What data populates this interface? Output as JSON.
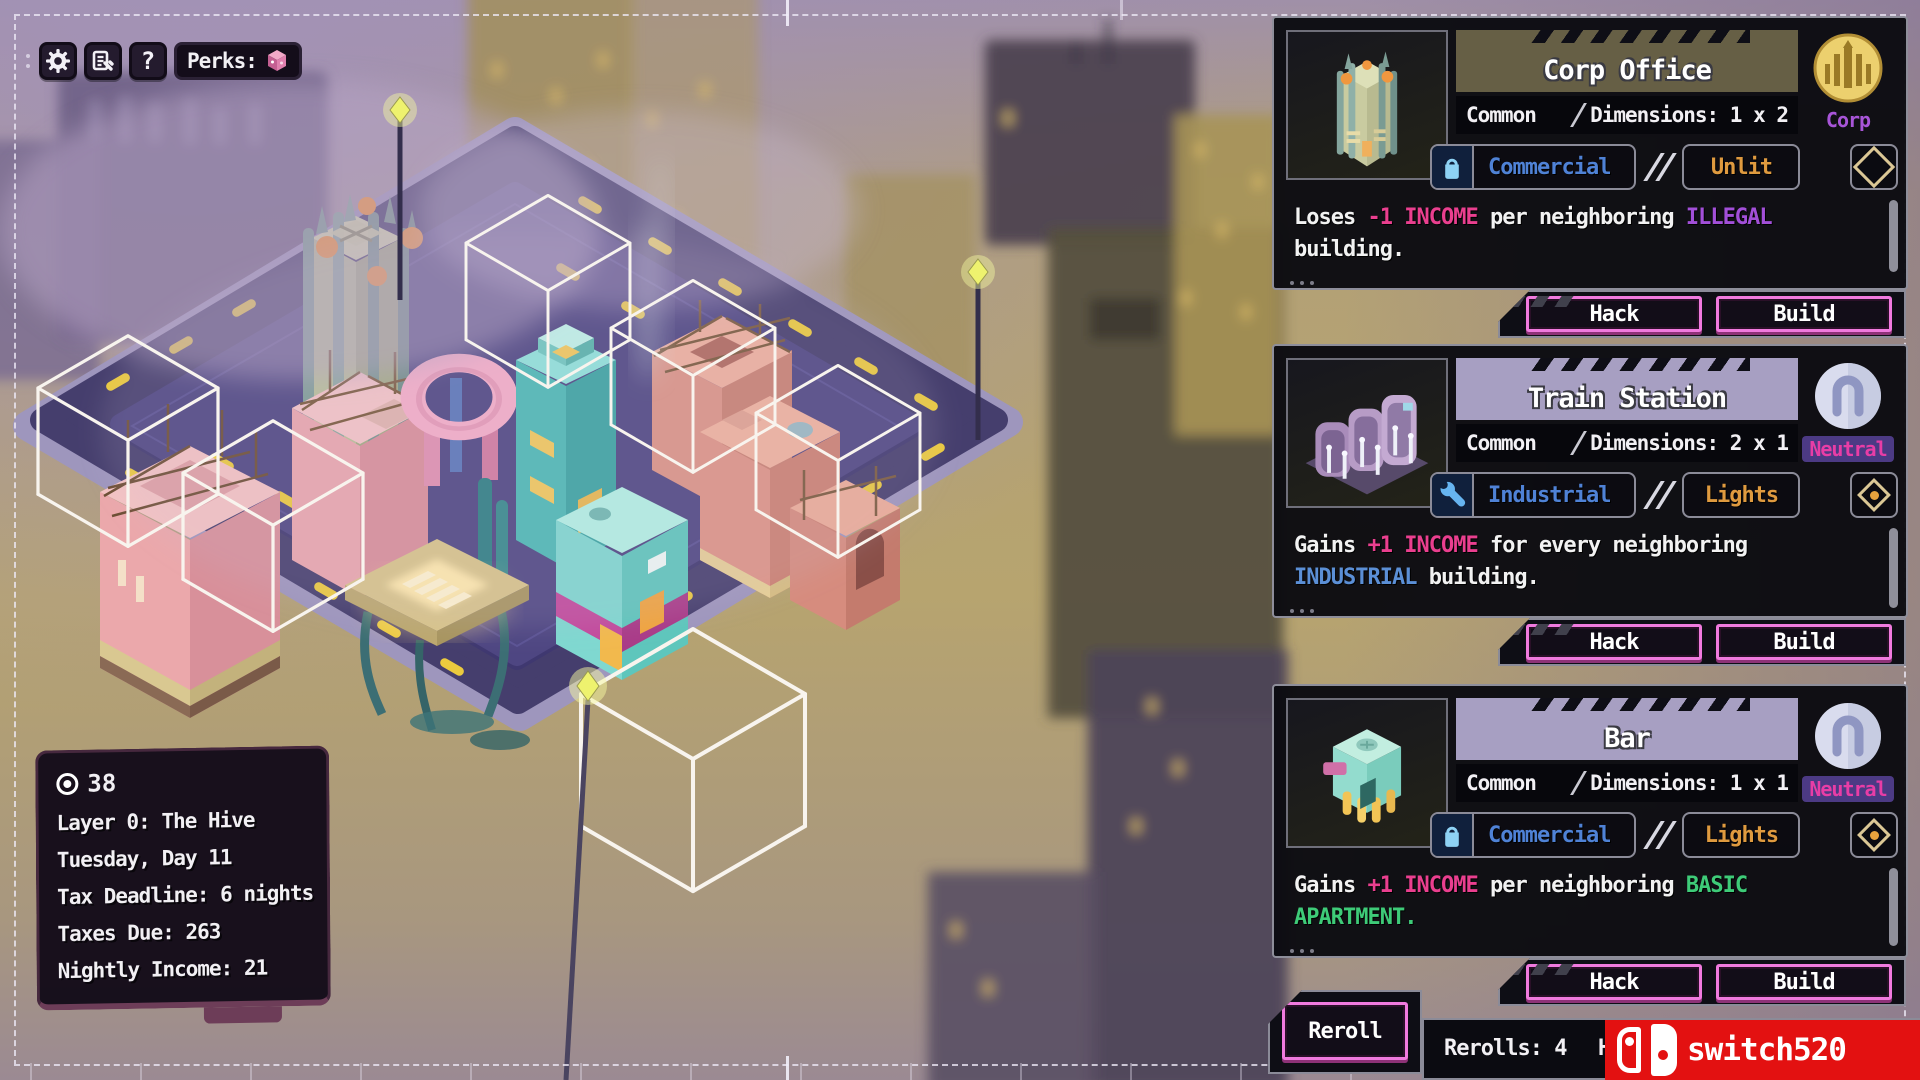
{
  "topbar": {
    "perks_label": "Perks:",
    "help_glyph": "?"
  },
  "stats": {
    "money": "38",
    "lines": [
      "Layer 0: The Hive",
      "Tuesday, Day 11",
      "Tax Deadline: 6 nights",
      "Taxes Due: 263",
      "Nightly Income: 21"
    ]
  },
  "cards": [
    {
      "title": "Corp Office",
      "rarity": "Common",
      "dimensions": "Dimensions: 1 x 2",
      "faction": "Corp",
      "category": "Commercial",
      "lighting": "Unlit",
      "description": [
        {
          "t": "Loses ",
          "c": "w"
        },
        {
          "t": "-1 INCOME",
          "c": "pk"
        },
        {
          "t": " per neighboring ",
          "c": "w"
        },
        {
          "t": "ILLEGAL",
          "c": "pu"
        },
        {
          "t": " building.",
          "c": "w"
        }
      ]
    },
    {
      "title": "Train Station",
      "rarity": "Common",
      "dimensions": "Dimensions: 2 x 1",
      "faction": "Neutral",
      "category": "Industrial",
      "lighting": "Lights",
      "description": [
        {
          "t": "Gains ",
          "c": "w"
        },
        {
          "t": "+1 INCOME",
          "c": "pk"
        },
        {
          "t": " for every neighboring ",
          "c": "w"
        },
        {
          "t": "INDUSTRIAL",
          "c": "bl"
        },
        {
          "t": " building.",
          "c": "w"
        }
      ]
    },
    {
      "title": "Bar",
      "rarity": "Common",
      "dimensions": "Dimensions: 1 x 1",
      "faction": "Neutral",
      "category": "Commercial",
      "lighting": "Lights",
      "description": [
        {
          "t": "Gains ",
          "c": "w"
        },
        {
          "t": "+1 INCOME",
          "c": "pk"
        },
        {
          "t": " per neighboring ",
          "c": "w"
        },
        {
          "t": "BASIC APARTMENT.",
          "c": "gr"
        }
      ]
    }
  ],
  "card_buttons": {
    "hack": "Hack",
    "build": "Build"
  },
  "footer": {
    "reroll": "Reroll",
    "rerolls": "Rerolls: 4",
    "hand_partial": "H"
  },
  "watermark": "switch520",
  "accent_colors": {
    "income_pink": "#ea3f8f",
    "illegal_purple": "#a24fd8",
    "industrial_blue": "#5b8fd6",
    "basic_green": "#3ecb78",
    "lights_orange": "#df9a3f",
    "button_pink": "#f07ade",
    "corp_label": "#a855d8",
    "neutral_label": "#e83da6"
  }
}
